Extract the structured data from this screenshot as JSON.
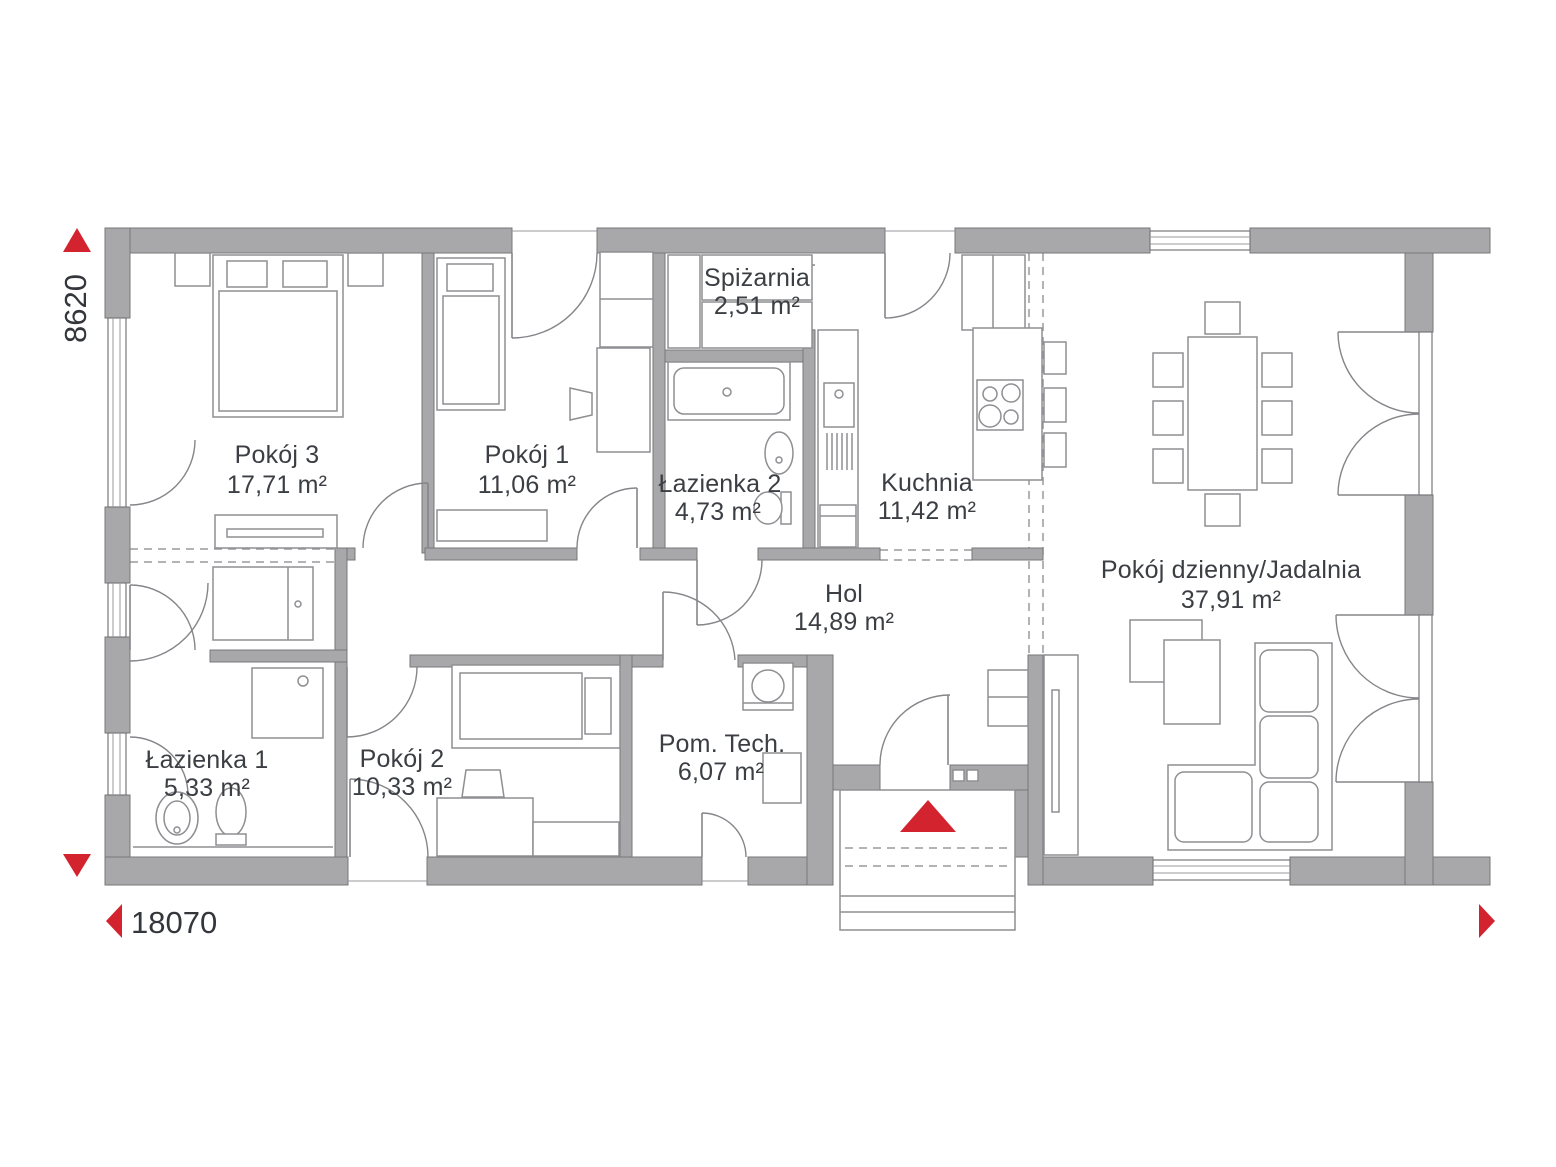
{
  "plan": {
    "title": "Rzut parteru",
    "rooms": [
      {
        "name": "Pokój 3",
        "area": "17,71 m²"
      },
      {
        "name": "Pokój 1",
        "area": "11,06 m²"
      },
      {
        "name": "Spiżarnia",
        "area": "2,51 m²"
      },
      {
        "name": "Łazienka 2",
        "area": "4,73 m²"
      },
      {
        "name": "Kuchnia",
        "area": "11,42 m²"
      },
      {
        "name": "Pokój dzienny/Jadalnia",
        "area": "37,91 m²"
      },
      {
        "name": "Hol",
        "area": "14,89 m²"
      },
      {
        "name": "Łazienka 1",
        "area": "5,33 m²"
      },
      {
        "name": "Pokój 2",
        "area": "10,33 m²"
      },
      {
        "name": "Pom. Tech.",
        "area": "6,07 m²"
      }
    ],
    "dimensions": {
      "height_mm": "8620",
      "width_mm": "18070"
    },
    "colors": {
      "wall": "#a8a8aa",
      "accent_red": "#d2232e",
      "text": "#3b3e43"
    }
  }
}
